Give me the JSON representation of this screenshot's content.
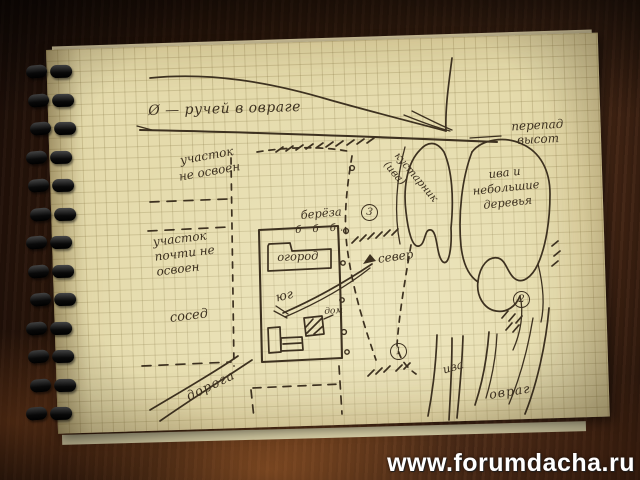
{
  "watermark": {
    "text": "www.forumdacha.ru"
  },
  "colors": {
    "ink": "#3d3120",
    "paper": "#e5dbac",
    "wood": "#46271",
    "watermark": "#ffffff"
  },
  "map": {
    "labels": {
      "stream": "Ø — ручей в овраге",
      "elevation": "перепад высот",
      "plot_undeveloped": "участок не освоен",
      "plot_almost_undeveloped": "участок почти не освоен",
      "neighbor": "сосед",
      "road": "дорога",
      "birch": "берёза",
      "birch_row": "б б б.",
      "garden": "огород",
      "north": "север",
      "south": "юг",
      "house": "дом",
      "willow_shrub": "кустарник (ива)",
      "small_trees": "ива и небольшие деревья",
      "willow_bottom": "ива",
      "ravine": "овраг"
    },
    "markers": {
      "m1": "1",
      "m2": "2",
      "m3": "3"
    }
  }
}
